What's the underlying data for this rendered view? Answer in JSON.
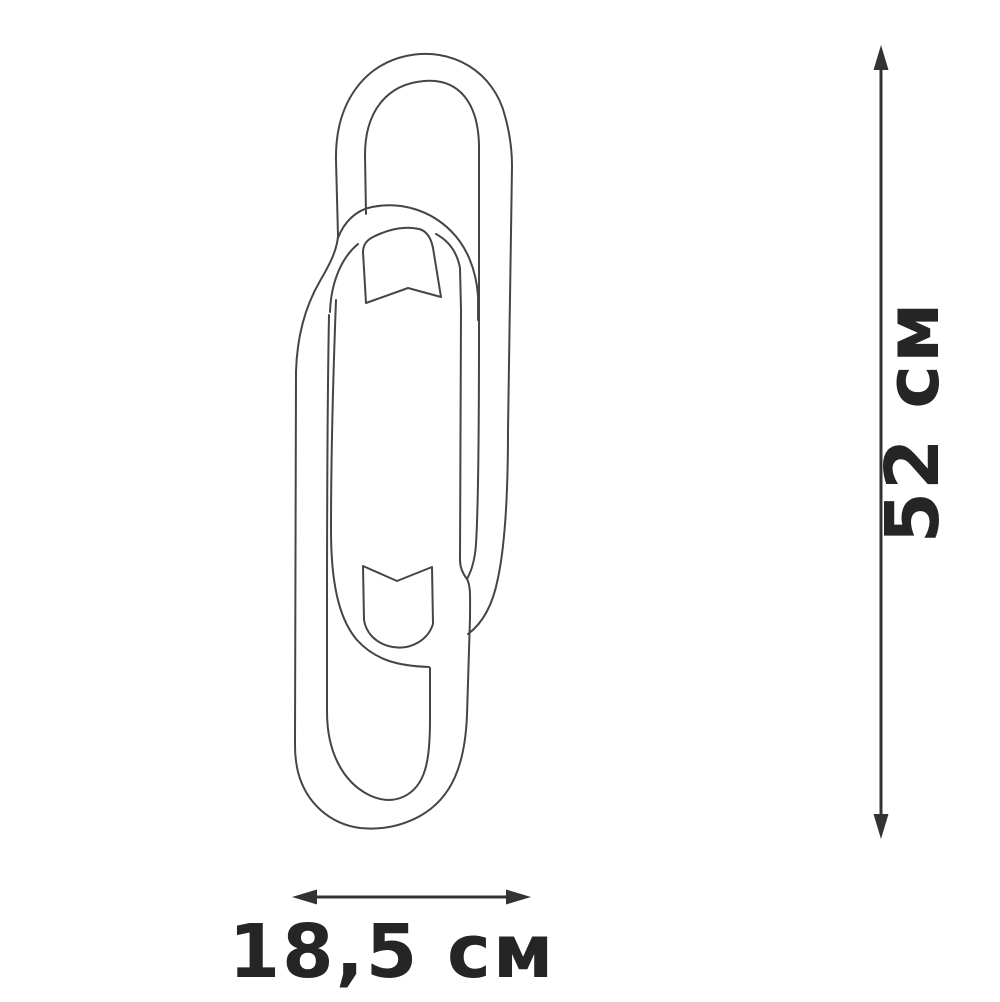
{
  "figure": {
    "kind": "product-dimension-diagram",
    "subject": "wall-lamp line drawing: two interlocked oval links with two small shades",
    "background_color": "#ffffff",
    "outline_color": "#454545",
    "dimension_color": "#333333",
    "text_color": "#252525"
  },
  "dimensions": {
    "height_label": "52 см",
    "height_value": "52",
    "width_label": "18,5 см",
    "width_value": "18,5",
    "unit": "см"
  }
}
